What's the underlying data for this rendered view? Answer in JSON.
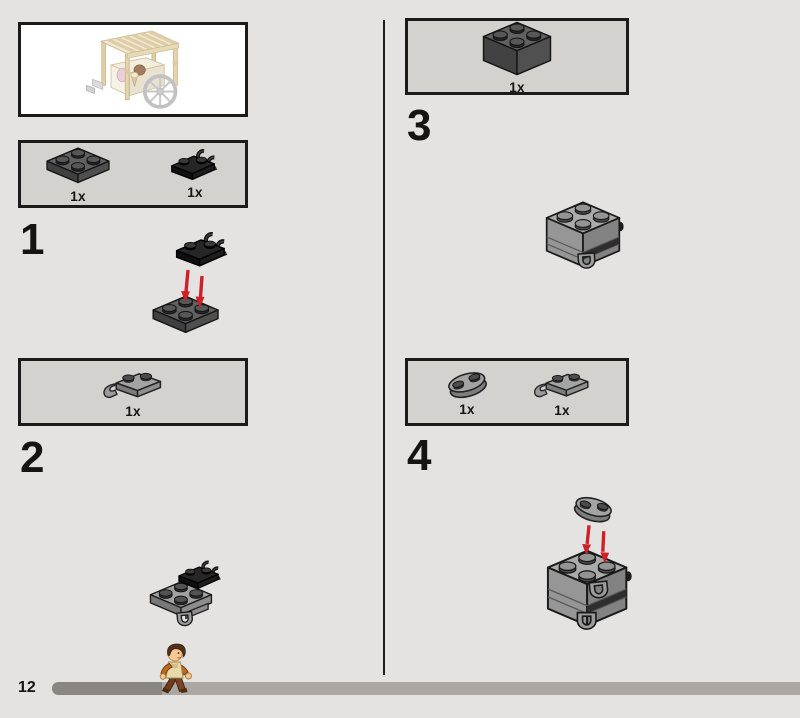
{
  "page": {
    "number": "12"
  },
  "steps": {
    "s1": "1",
    "s2": "2",
    "s3": "3",
    "s4": "4"
  },
  "panels": {
    "preview": {
      "icon": "ice-cream-cart-model-preview"
    },
    "box1": {
      "items": [
        {
          "qty": "1x",
          "icon": "plate-2x2-dark-gray"
        },
        {
          "qty": "1x",
          "icon": "plate-1x2-double-clip-black"
        }
      ]
    },
    "box2": {
      "items": [
        {
          "qty": "1x",
          "icon": "plate-1x2-end-clip-gray"
        }
      ]
    },
    "box3": {
      "items": [
        {
          "qty": "1x",
          "icon": "brick-2x2-dark-gray"
        }
      ]
    },
    "box4": {
      "items": [
        {
          "qty": "1x",
          "icon": "plate-1x2-rounded-gray"
        },
        {
          "qty": "1x",
          "icon": "plate-1x2-end-clip-gray"
        }
      ]
    }
  },
  "diagrams": {
    "step1": "place-black-clip-plate-on-2x2-plate",
    "step2_result": "subassembly-with-hanging-clip",
    "step3_result": "brick-stack-with-clip",
    "step4": "place-rounded-plate-on-stack"
  },
  "colors": {
    "background": "#e4e3e1",
    "panel_fill": "#d3d2cf",
    "panel_border": "#1b1b1b",
    "preview_fill": "#ffffff",
    "arrow_red": "#cf2028",
    "progress_track": "#aba7a3",
    "progress_fill": "#8a8682",
    "dark_gray_part": "#4f4f4f",
    "light_gray_part": "#a2a2a2",
    "black_part": "#1d1d1d",
    "text": "#141414"
  }
}
